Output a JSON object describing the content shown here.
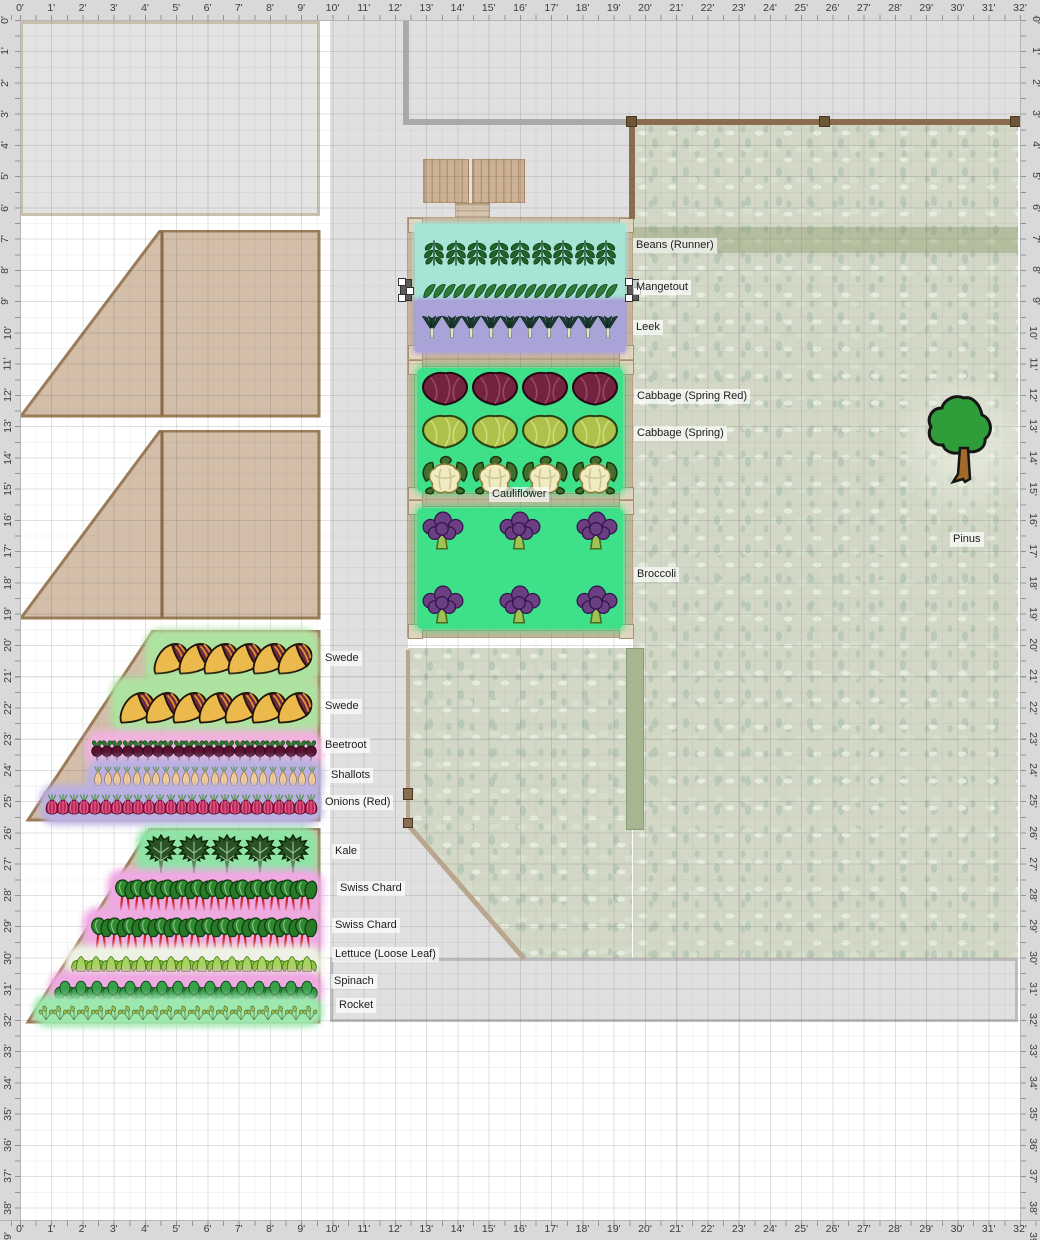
{
  "meta": {
    "view": "garden-plan-canvas",
    "unit": "feet"
  },
  "rulers": {
    "horizontal_feet": 32,
    "vertical_feet": 39,
    "px_per_foot": 31.25,
    "origin_px": 20,
    "unit_suffix": "'"
  },
  "palette": {
    "ruler_bg": "#d9d9d9",
    "paving": "#e0e0e0",
    "grass": "#d3d8c6",
    "wood_fill": "#cfb9a2",
    "wood_edge": "#9b7c59",
    "bed_frame": "#cbb59b",
    "row_teal": "#a7e4d6",
    "row_purple": "#a9a3d8",
    "bed_green": "#3ee089",
    "glow_green": "#aee2a0",
    "glow_pink": "#efaae2",
    "glow_lavender": "#bab1e2",
    "glow_pale": "#eef2e4",
    "selection": "#5a5a5a",
    "hedge": "#a6b690"
  },
  "labels": [
    {
      "text": "Beans (Runner)",
      "x": 633,
      "y": 238
    },
    {
      "text": "Mangetout",
      "x": 633,
      "y": 280
    },
    {
      "text": "Leek",
      "x": 633,
      "y": 320
    },
    {
      "text": "Cabbage (Spring Red)",
      "x": 634,
      "y": 389
    },
    {
      "text": "Cabbage (Spring)",
      "x": 634,
      "y": 426
    },
    {
      "text": "Cauliflower",
      "x": 489,
      "y": 487
    },
    {
      "text": "Broccoli",
      "x": 634,
      "y": 567
    },
    {
      "text": "Swede",
      "x": 322,
      "y": 651
    },
    {
      "text": "Swede",
      "x": 322,
      "y": 699
    },
    {
      "text": "Beetroot",
      "x": 322,
      "y": 738
    },
    {
      "text": "Shallots",
      "x": 328,
      "y": 768
    },
    {
      "text": "Onions (Red)",
      "x": 322,
      "y": 795
    },
    {
      "text": "Kale",
      "x": 332,
      "y": 844
    },
    {
      "text": "Swiss Chard",
      "x": 337,
      "y": 881
    },
    {
      "text": "Swiss Chard",
      "x": 332,
      "y": 918
    },
    {
      "text": "Lettuce (Loose Leaf)",
      "x": 332,
      "y": 947
    },
    {
      "text": "Spinach",
      "x": 331,
      "y": 974
    },
    {
      "text": "Rocket",
      "x": 336,
      "y": 998
    },
    {
      "text": "Pinus",
      "x": 950,
      "y": 532
    }
  ],
  "wood_beds": [
    {
      "name": "raised-bed-empty-1",
      "x": 20,
      "y": 230,
      "w": 302,
      "h": 188,
      "points": "140,1 299,1 299,186 1,186",
      "divider": [
        142,
        1,
        142,
        186
      ]
    },
    {
      "name": "raised-bed-empty-2",
      "x": 20,
      "y": 430,
      "w": 302,
      "h": 190,
      "points": "140,1 299,1 299,188 1,188",
      "divider": [
        142,
        1,
        142,
        188
      ]
    },
    {
      "name": "bed-roots-alliums",
      "x": 20,
      "y": 630,
      "w": 302,
      "h": 192,
      "points": "133,1 299,1 299,190 8,190",
      "divider": [
        142,
        1,
        142,
        190
      ]
    },
    {
      "name": "bed-leafy-greens",
      "x": 20,
      "y": 828,
      "w": 302,
      "h": 196,
      "points": "130,1 299,1 299,194 8,194",
      "divider": [
        142,
        1,
        142,
        194
      ]
    }
  ],
  "middle_beds": [
    {
      "name": "bed-legumes",
      "x": 408,
      "y": 218,
      "w": 224,
      "h": 140,
      "rows": [
        {
          "label": "Beans (Runner)",
          "icon": "bean-runner",
          "count": 9,
          "y": 6,
          "h": 56,
          "bg": "#a7e4d6",
          "icon_w": 28,
          "icon_h": 54
        },
        {
          "label": "Mangetout",
          "icon": "mangetout",
          "count": 19,
          "y": 62,
          "h": 20,
          "bg": "#a7e4d6",
          "icon_w": 18,
          "icon_h": 20,
          "selected": true
        },
        {
          "label": "Leek",
          "icon": "leek",
          "count": 10,
          "y": 82,
          "h": 52,
          "bg": "#a9a3d8",
          "icon_w": 24,
          "icon_h": 50
        }
      ]
    },
    {
      "name": "bed-brassica-upper",
      "x": 408,
      "y": 360,
      "w": 224,
      "h": 140,
      "inset": "#3ee089",
      "rows": [
        {
          "label": "Cabbage (Spring Red)",
          "icon": "cabbage-red",
          "count": 4,
          "y": 8,
          "h": 44,
          "icon_w": 50,
          "icon_h": 44
        },
        {
          "label": "Cabbage (Spring)",
          "icon": "cabbage-green",
          "count": 4,
          "y": 50,
          "h": 46,
          "icon_w": 50,
          "icon_h": 46
        },
        {
          "label": "Cauliflower",
          "icon": "cauliflower",
          "count": 4,
          "y": 94,
          "h": 42,
          "icon_w": 50,
          "icon_h": 42
        }
      ]
    },
    {
      "name": "bed-brassica-lower",
      "x": 408,
      "y": 500,
      "w": 224,
      "h": 137,
      "inset": "#3ee089",
      "rows": [
        {
          "label": "Broccoli",
          "icon": "broccoli",
          "count": 3,
          "y": 6,
          "h": 48,
          "icon_w": 46,
          "icon_h": 46
        },
        {
          "label": "Broccoli",
          "icon": "broccoli",
          "count": 3,
          "y": 80,
          "h": 48,
          "icon_w": 46,
          "icon_h": 46
        }
      ]
    }
  ],
  "ground_rows": [
    {
      "label": "Swede",
      "icon": "swede",
      "count": 6,
      "x": 150,
      "y": 634,
      "w": 164,
      "h": 46,
      "glow": "#aee2a0",
      "icon_w": 40,
      "icon_h": 42
    },
    {
      "label": "Swede",
      "icon": "swede",
      "count": 7,
      "x": 116,
      "y": 682,
      "w": 198,
      "h": 48,
      "glow": "#aee2a0",
      "icon_w": 40,
      "icon_h": 44
    },
    {
      "label": "Beetroot",
      "icon": "beetroot",
      "count": 22,
      "x": 90,
      "y": 735,
      "w": 228,
      "h": 30,
      "glow": "#efb3de",
      "icon_w": 14,
      "icon_h": 30
    },
    {
      "label": "Shallots",
      "icon": "shallot",
      "count": 23,
      "x": 92,
      "y": 763,
      "w": 226,
      "h": 28,
      "glow": "#bab1e2",
      "icon_w": 12,
      "icon_h": 28
    },
    {
      "label": "Onions (Red)",
      "icon": "onion-red",
      "count": 25,
      "x": 45,
      "y": 790,
      "w": 273,
      "h": 30,
      "glow": "#bab1e2",
      "icon_w": 14,
      "icon_h": 30
    },
    {
      "label": "Kale",
      "icon": "kale",
      "count": 5,
      "x": 142,
      "y": 832,
      "w": 170,
      "h": 44,
      "glow": "#8fe4a5",
      "icon_w": 38,
      "icon_h": 42
    },
    {
      "label": "Swiss Chard",
      "icon": "swiss-chard",
      "count": 13,
      "x": 112,
      "y": 874,
      "w": 206,
      "h": 40,
      "glow": "#efaae2",
      "icon_w": 26,
      "icon_h": 38
    },
    {
      "label": "Swiss Chard",
      "icon": "swiss-chard",
      "count": 14,
      "x": 88,
      "y": 912,
      "w": 230,
      "h": 40,
      "glow": "#efaae2",
      "icon_w": 26,
      "icon_h": 38
    },
    {
      "label": "Lettuce (Loose Leaf)",
      "icon": "lettuce",
      "count": 16,
      "x": 70,
      "y": 950,
      "w": 248,
      "h": 26,
      "glow": "#eef2e4",
      "icon_w": 22,
      "icon_h": 24
    },
    {
      "label": "Spinach",
      "icon": "spinach",
      "count": 16,
      "x": 54,
      "y": 976,
      "w": 264,
      "h": 26,
      "glow": "#efaae2",
      "icon_w": 22,
      "icon_h": 24
    },
    {
      "label": "Rocket",
      "icon": "rocket",
      "count": 20,
      "x": 38,
      "y": 1000,
      "w": 280,
      "h": 22,
      "glow": "#9ce8ae",
      "icon_w": 16,
      "icon_h": 20
    }
  ],
  "tree": {
    "label": "Pinus",
    "x": 922,
    "y": 392,
    "w": 84,
    "h": 100
  }
}
